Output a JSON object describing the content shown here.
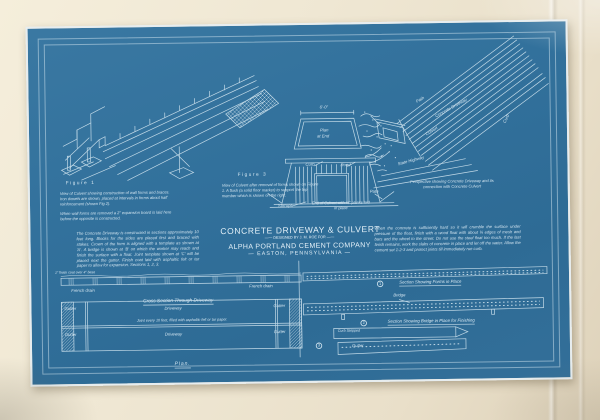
{
  "colors": {
    "paper": "#efe7d3",
    "blueprint": "#32719c",
    "ink": "#d8e9f3"
  },
  "title_block": {
    "line1": "CONCRETE DRIVEWAY & CULVERT",
    "line2": "—— DESIGNED BY J. M. ROE FOR ——",
    "line3": "ALPHA PORTLAND CEMENT COMPANY",
    "line4": "— EASTON, PENNSYLVANIA —"
  },
  "figure1": {
    "label": "Figure 1",
    "caption": "View of Culvert showing construction of wall forms and braces.  Iron dowels are shown, placed at intervals in forms about half reinforcement (shown Fig 2).",
    "caption2": "When wall forms are removed a 2\" expansion board is laid here before the opposite is constructed."
  },
  "figure3": {
    "label": "Figure 3",
    "caption": "View of Culvert after removal of forms shown on Figure 1.  A flush (a solid floor marker) to support the top member which is shown on the right.",
    "dim_label": "6'-0\"",
    "plan_label_1": "Plan",
    "plan_label_2": "at End",
    "curb_label": "Curb",
    "road_label": "Road",
    "path_label": "Path",
    "stirrups_label": "Stirrups",
    "end_caption": "End of Culvert with ¾\" planks laid in place"
  },
  "perspective": {
    "caption": "Perspective showing Concrete Driveway and its connection with Concrete Culvert",
    "path_label": "Path",
    "driveway_label": "Concrete Driveway",
    "culvert_label": "Culvert",
    "highway_label": "State Highway",
    "curb_label": "Curb"
  },
  "left_note": "The Concrete Driveway is constructed in sections approximately 10 feet long.  Blocks for the sides are placed first and braced with stakes.  Crown of the form is aligned with a template as shown at 'A'.  A bridge is shown at 'B' on which the worker may reach and finish the surface with a float.  Joint template shown at 'C' will be placed next the gutter.  Finish coat laid with asphaltic felt or tar paper to allow for expansion.  Sections 1, 2, 3.",
  "right_note": "When the concrete is sufficiently hard so it will crumble the surface under pressure of the float, finish with a wood float with about ¾ edges of mesh and bars and the wheel to the street.  Do not use the steel float too much.  If the last finish remains, work the slabs of concrete in place and let off the water.  Allow the cement set 1-2-3 and protect joints till immediately run curb.",
  "bottom_left": {
    "left_note": "1\" finish coat over 4\" base",
    "left_drain": "French drain",
    "right_drain": "French drain",
    "section_title": "Cross Section Through Driveway",
    "gutter": "Gutter",
    "driveway": "Driveway",
    "joint_note": "Joint every 10 feet, filled with asphaltic felt or tar paper.",
    "plan_title": "Plan."
  },
  "bottom_right": {
    "num1": "1",
    "caption1": "Section Showing Forms in Place",
    "bridge_label": "Bridge",
    "num2": "2",
    "caption2": "Section Showing Bridge in Place for Finishing",
    "num3": "3",
    "curb_label": "Curb Stripped",
    "gutter_label": "Gutter"
  }
}
